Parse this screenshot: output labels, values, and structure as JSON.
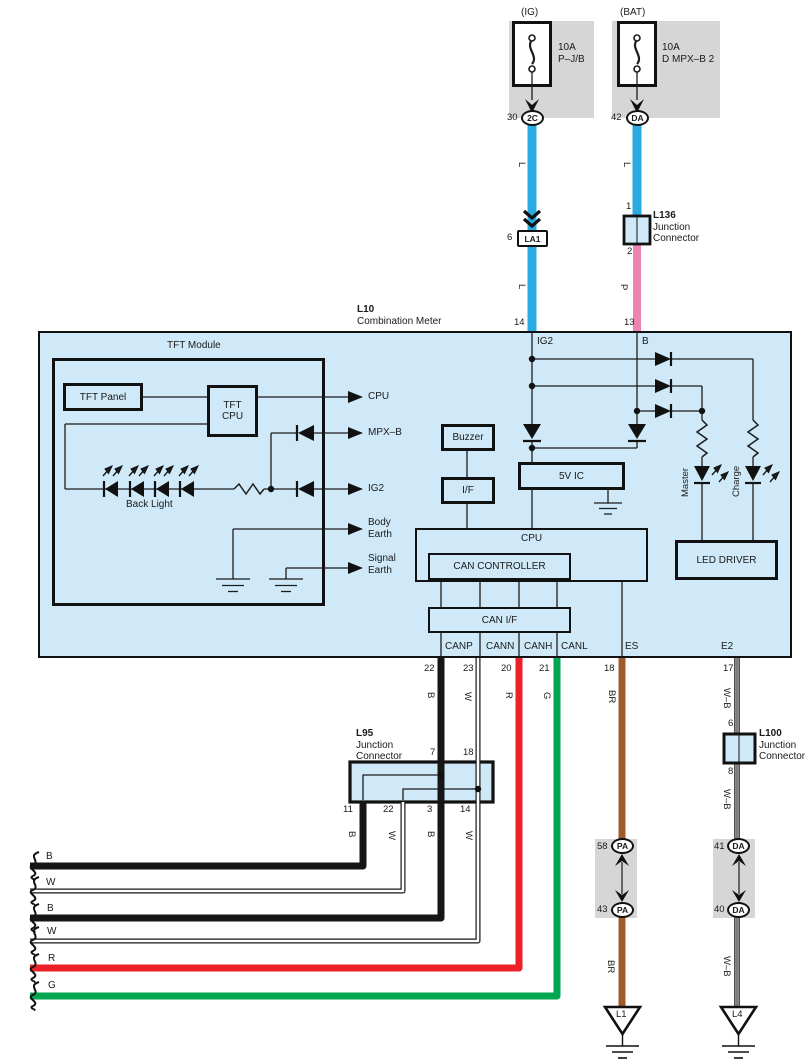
{
  "power": {
    "ig_title": "(IG)",
    "bat_title": "(BAT)",
    "fuse_ig_rating": "10A",
    "fuse_ig_name": "P–J/B",
    "fuse_bat_rating": "10A",
    "fuse_bat_name": "D MPX–B 2",
    "conn_ig_pin": "30",
    "conn_ig_code": "2C",
    "conn_bat_pin": "42",
    "conn_bat_code": "DA"
  },
  "feed": {
    "wire_l_left_upper": "L",
    "wire_l_left_lower": "L",
    "wire_l_right": "L",
    "wire_p": "P",
    "la1_pin": "6",
    "la1_code": "LA1",
    "l136_id": "L136",
    "l136_line1": "Junction",
    "l136_line2": "Connector",
    "l136_pin_top": "1",
    "l136_pin_bot": "2",
    "meter_pin14": "14",
    "meter_pin13": "13"
  },
  "meter": {
    "id": "L10",
    "name": "Combination Meter",
    "term_ig2": "IG2",
    "term_b": "B",
    "tft_title": "TFT Module",
    "tft_panel": "TFT Panel",
    "tft_cpu_1": "TFT",
    "tft_cpu_2": "CPU",
    "arrow_cpu": "CPU",
    "arrow_mpxb": "MPX–B",
    "arrow_ig2": "IG2",
    "arrow_body_1": "Body",
    "arrow_body_2": "Earth",
    "arrow_sig_1": "Signal",
    "arrow_sig_2": "Earth",
    "backlight": "Back Light",
    "buzzer": "Buzzer",
    "iface": "I/F",
    "five_v": "5V IC",
    "cpu": "CPU",
    "can_controller": "CAN CONTROLLER",
    "can_if": "CAN I/F",
    "led_driver": "LED DRIVER",
    "led_master": "Master",
    "led_charge": "Charge",
    "term_canp": "CANP",
    "term_cann": "CANN",
    "term_canh": "CANH",
    "term_canl": "CANL",
    "term_es": "ES",
    "term_e2": "E2"
  },
  "lower": {
    "pin22": "22",
    "pin23": "23",
    "pin20": "20",
    "pin21": "21",
    "pin18": "18",
    "pin17": "17",
    "w_b": "B",
    "w_w": "W",
    "w_r": "R",
    "w_g": "G",
    "w_br": "BR",
    "w_wb": "W–B",
    "l95_id": "L95",
    "l95_line1": "Junction",
    "l95_line2": "Connector",
    "l95_top7": "7",
    "l95_top18": "18",
    "l95_b11": "11",
    "l95_b22": "22",
    "l95_b3": "3",
    "l95_b14": "14",
    "l95_wb1": "B",
    "l95_ww1": "W",
    "l95_wb2": "B",
    "l95_ww2": "W",
    "h_b1": "B",
    "h_w1": "W",
    "h_b2": "B",
    "h_w2": "W",
    "h_r": "R",
    "h_g": "G",
    "br_lower": "BR",
    "wb_mid": "W–B",
    "wb_lower": "W–B",
    "pa_top_pin": "58",
    "pa_top_code": "PA",
    "pa_bot_pin": "43",
    "pa_bot_code": "PA",
    "da_top_pin": "41",
    "da_top_code": "DA",
    "da_bot_pin": "40",
    "da_bot_code": "DA",
    "l100_id": "L100",
    "l100_line1": "Junction",
    "l100_line2": "Connector",
    "l100_pin6": "6",
    "l100_pin8": "8",
    "gnd_l1": "L1",
    "gnd_l4": "L4"
  },
  "colors": {
    "wire_blue": "#2aabe2",
    "wire_pink": "#ee82b2",
    "wire_red": "#ec2028",
    "wire_green": "#00a650",
    "wire_brown": "#a05b2e",
    "wire_black": "#161616",
    "panel_fill": "#cfe9f8",
    "connector_gray": "#d6d6d6"
  }
}
